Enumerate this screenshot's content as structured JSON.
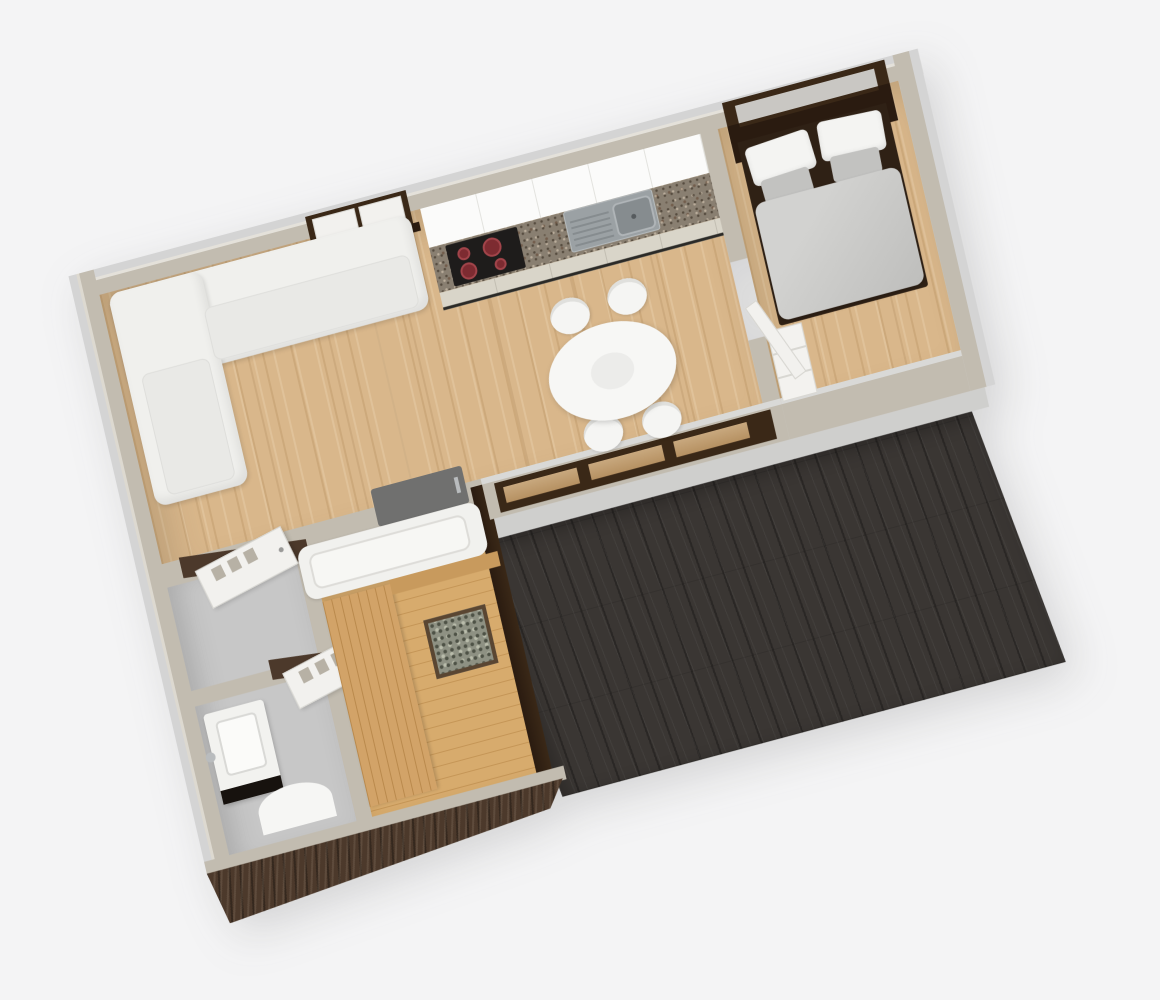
{
  "scene": {
    "type": "3d-floor-plan-render",
    "view": "rotated-top-down-perspective",
    "background": "#f4f4f5",
    "rooms": [
      {
        "name": "living-room",
        "floor": "light-oak",
        "furniture": [
          "corner-sofa",
          "dining-table",
          "dining-chair",
          "dining-chair",
          "dining-chair",
          "dining-chair"
        ]
      },
      {
        "name": "kitchen",
        "floor": "light-oak",
        "furniture": [
          "cabinet-run",
          "granite-counter",
          "cooktop-4-burners",
          "sink-with-drainboard",
          "window-with-shutters"
        ]
      },
      {
        "name": "bedroom",
        "floor": "light-oak",
        "furniture": [
          "double-bed",
          "pillows",
          "gray-duvet",
          "dresser",
          "window-dark-frame",
          "door"
        ]
      },
      {
        "name": "bathroom",
        "floor": "gray-tile",
        "furniture": [
          "washbasin",
          "bathtub",
          "shower-mat",
          "door",
          "door",
          "door-swing-arc"
        ]
      },
      {
        "name": "sauna",
        "floor": "pine",
        "furniture": [
          "wood-bench",
          "backrest",
          "stone-heater"
        ]
      },
      {
        "name": "deck",
        "floor": "dark-stained-wood",
        "furniture": []
      }
    ],
    "window_count_front_wall": 3
  },
  "colors": {
    "bg": "#f4f4f5",
    "wallOuter": "#d4d4d4",
    "wallFace": "#c2bcb0",
    "ledge": "#d9d9d7",
    "sill": "#cfcfcd",
    "oak1": "#d9b78b",
    "pine1": "#d7ab6d",
    "pineBench": "#d2a368",
    "pineBenchLine": "#c89a5d",
    "tile": "#c7c7c7",
    "deck1": "#3a3633",
    "brownFrame": "#3a2817",
    "brownDark": "#2a1b10",
    "siding1": "#4c392b",
    "windowOak": "#c8a87e",
    "paneGray": "#c9c7c3",
    "bedframe": "#2f2115",
    "duvet": "#cbcbc9",
    "pillowGray": "#c2c2c0",
    "granite": "#897f71",
    "cream": "#d9d5c9",
    "cooktop": "#1e1c1b",
    "burner": "#7d2b31",
    "burnerRing": "#a2444a",
    "steel": "#9ba1a4",
    "steelDark": "#868c8f",
    "steelLight": "#b7bcbe",
    "matGray": "#70706f",
    "chrome": "#b9bcbe",
    "stone1": "#8e9183",
    "stone2": "#4e5246",
    "stone3": "#b9bcab"
  }
}
